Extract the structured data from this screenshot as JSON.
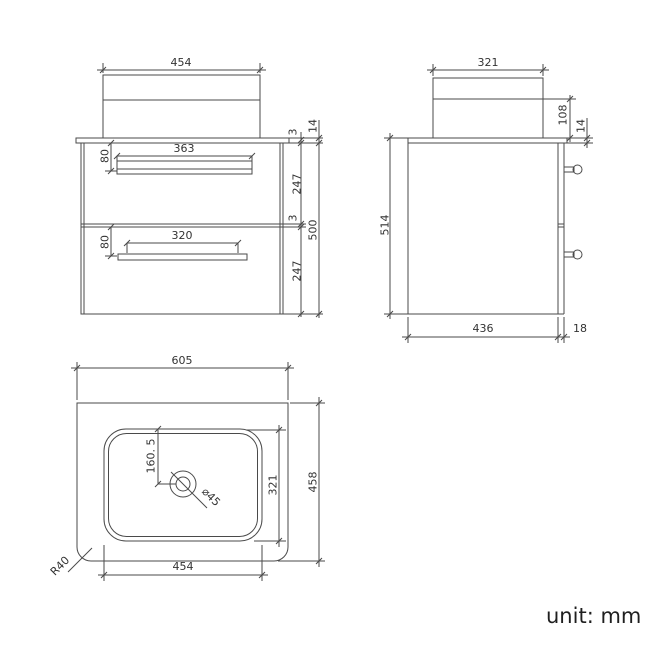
{
  "unit_note": "unit: mm",
  "colors": {
    "line": "#4a4a4a",
    "text": "#333333",
    "background": "#ffffff"
  },
  "front_view": {
    "basin_width": "454",
    "drawer1_handle_width": "363",
    "drawer1_handle_offset": "80",
    "drawer2_handle_width": "320",
    "drawer2_handle_offset": "80",
    "counter_gap": "3",
    "drawer1_front_height": "247",
    "drawer_gap": "3",
    "drawer2_front_height": "247",
    "cabinet_height": "500",
    "countertop_thickness": "14"
  },
  "side_view": {
    "basin_depth": "321",
    "basin_height_above_counter": "108",
    "countertop_thickness": "14",
    "overall_height": "514",
    "cabinet_depth": "436",
    "door_thickness": "18"
  },
  "plan_view": {
    "countertop_width": "605",
    "countertop_depth": "458",
    "basin_width": "454",
    "basin_depth": "321",
    "tap_hole_offset": "160. 5",
    "waste_hole_diameter": "⌀45",
    "corner_radius": "R40"
  }
}
